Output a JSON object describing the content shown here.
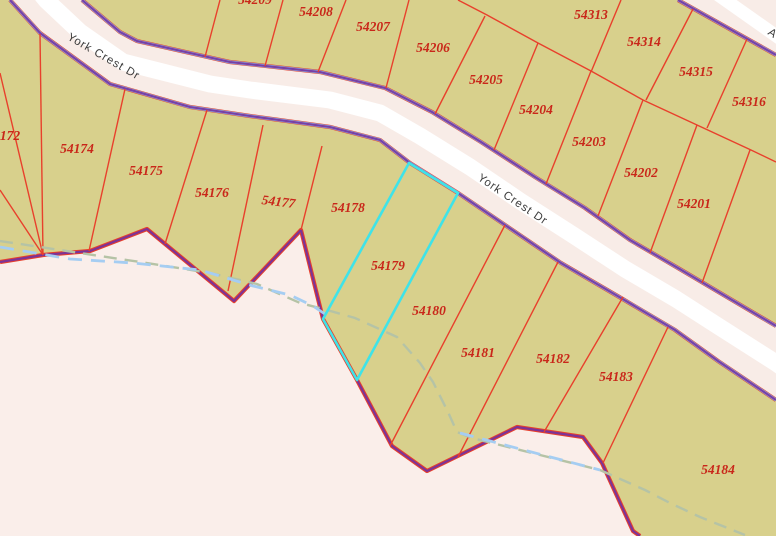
{
  "map": {
    "type": "cadastral-parcel-map",
    "selected_parcel": "54179",
    "streets": {
      "label1": "York Crest Dr",
      "label2": "York Crest Dr",
      "edge_fragment": "A"
    },
    "labels": {
      "p54209": "54209",
      "p54208": "54208",
      "p54207": "54207",
      "p54206": "54206",
      "p54205": "54205",
      "p54204": "54204",
      "p54203": "54203",
      "p54202": "54202",
      "p54201": "54201",
      "p54313": "54313",
      "p54314": "54314",
      "p54315": "54315",
      "p54316": "54316",
      "p172": "172",
      "p54174": "54174",
      "p54175": "54175",
      "p54176": "54176",
      "p54177": "54177",
      "p54178": "54178",
      "p54179": "54179",
      "p54180": "54180",
      "p54181": "54181",
      "p54182": "54182",
      "p54183": "54183",
      "p54184": "54184"
    },
    "colors": {
      "parcel_fill": "#d8d08c",
      "outside_fill": "#faeeea",
      "road_buffer_fill": "#f8ece7",
      "road_core": "#ffffff",
      "parcel_line_red": "#e8402c",
      "parcel_label_red": "#c9271a",
      "boundary_purple": "#7a3fa5",
      "road_edge_blue": "#84abe4",
      "selected_outline_cyan": "#3fe3e8",
      "stream_dash_blue": "#a5cdf2",
      "drainage_dash_sage": "#b5c3a6",
      "street_label_gray": "#3c3c3c"
    }
  }
}
